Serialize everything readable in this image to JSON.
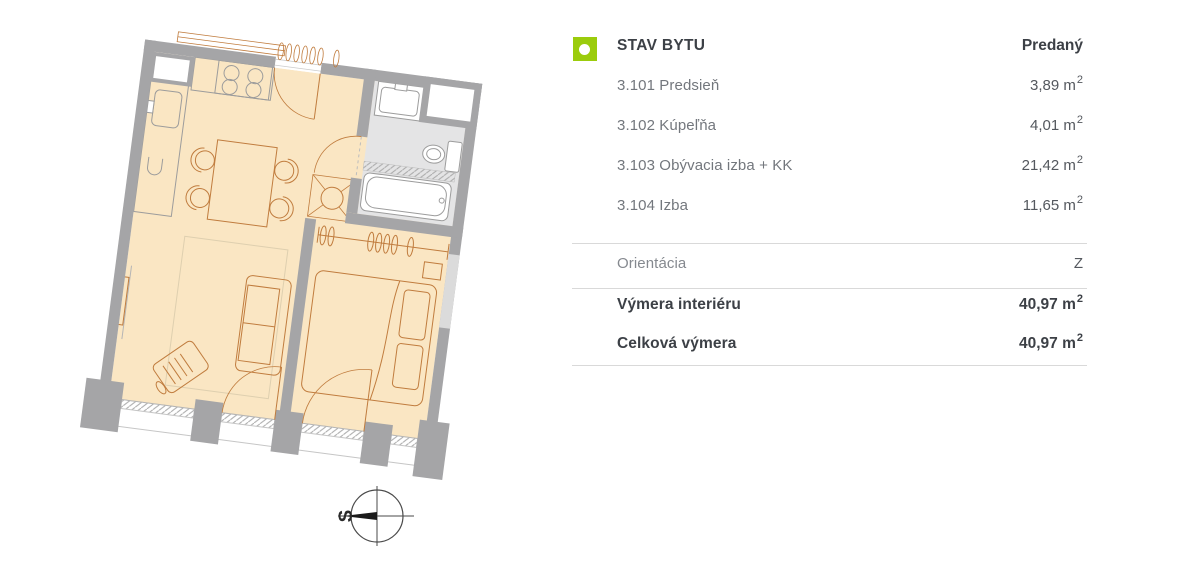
{
  "panel": {
    "header": {
      "label": "STAV BYTU",
      "value": "Predaný"
    },
    "rooms": [
      {
        "label": "3.101 Predsieň",
        "value": "3,89 m",
        "sup": "2"
      },
      {
        "label": "3.102 Kúpeľňa",
        "value": "4,01 m",
        "sup": "2"
      },
      {
        "label": "3.103 Obývacia izba + KK",
        "value": "21,42 m",
        "sup": "2"
      },
      {
        "label": "3.104 Izba",
        "value": "11,65 m",
        "sup": "2"
      }
    ],
    "orientation": {
      "label": "Orientácia",
      "value": "Z"
    },
    "summary": [
      {
        "label": "Výmera interiéru",
        "value": "40,97 m",
        "sup": "2"
      },
      {
        "label": "Celková výmera",
        "value": "40,97 m",
        "sup": "2"
      }
    ]
  },
  "floorplan": {
    "compass_label": "S",
    "colors": {
      "accent": "#9BCC0C",
      "wall": "#A5A5A7",
      "floor": "#FAE6C3",
      "bath": "#E4E4E5",
      "line": "#C07C3E",
      "fixture": "#9C9C9C",
      "divider": "#D9D9D9",
      "text-dark": "#3C4046",
      "text-gray": "#73777D",
      "text-mid": "#54585E"
    }
  }
}
